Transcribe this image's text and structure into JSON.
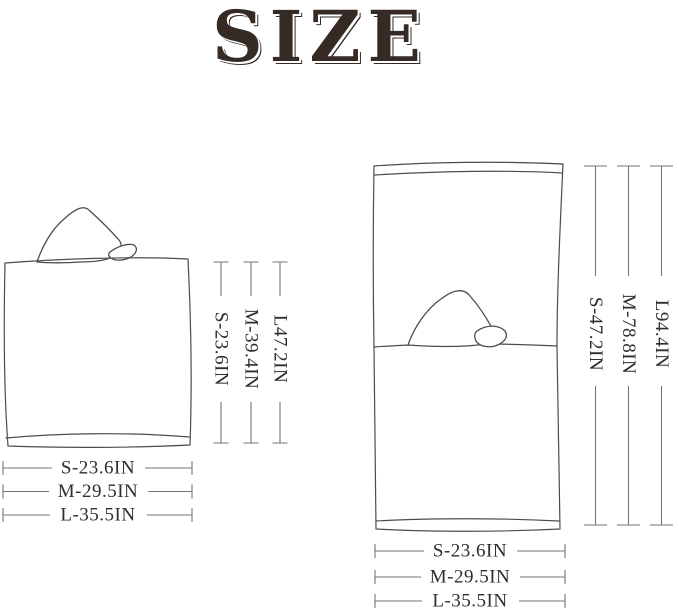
{
  "title": "SIZE",
  "colors": {
    "background": "#ffffff",
    "title_text": "#352a24",
    "drawing_line": "#4c4c4c",
    "dimension_line": "#757575",
    "dimension_text": "#2e2e2e"
  },
  "figures": {
    "folded": {
      "name": "folded hooded towel (front view)",
      "height_dims": [
        {
          "label": "S-23.6IN"
        },
        {
          "label": "M-39.4IN"
        },
        {
          "label": "L47.2IN"
        }
      ],
      "width_dims": [
        {
          "label": "S-23.6IN"
        },
        {
          "label": "M-29.5IN"
        },
        {
          "label": "L-35.5IN"
        }
      ]
    },
    "unfolded": {
      "name": "unfolded hooded towel (full length)",
      "height_dims": [
        {
          "label": "S-47.2IN"
        },
        {
          "label": "M-78.8IN"
        },
        {
          "label": "L94.4IN"
        }
      ],
      "width_dims": [
        {
          "label": "S-23.6IN"
        },
        {
          "label": "M-29.5IN"
        },
        {
          "label": "L-35.5IN"
        }
      ]
    }
  }
}
